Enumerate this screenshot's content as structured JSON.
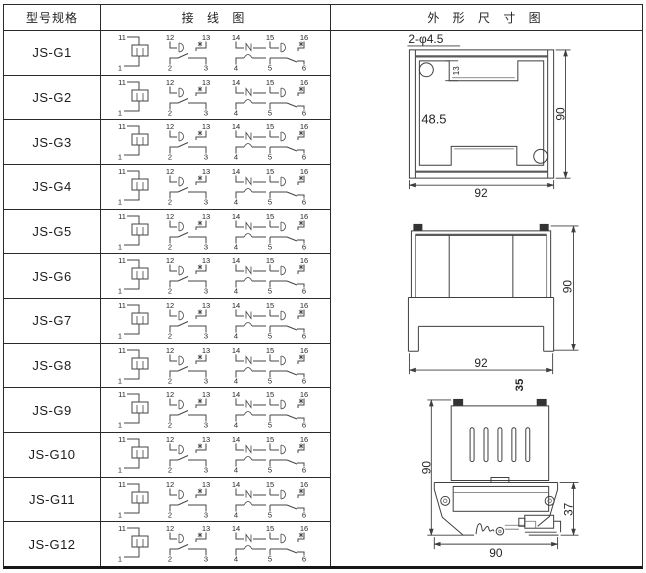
{
  "header": {
    "col_model": "型号规格",
    "col_wiring": "接 线 图",
    "col_outline": "外 形 尺 寸 图"
  },
  "table": {
    "rows": [
      {
        "model": "JS-G1"
      },
      {
        "model": "JS-G2"
      },
      {
        "model": "JS-G3"
      },
      {
        "model": "JS-G4"
      },
      {
        "model": "JS-G5"
      },
      {
        "model": "JS-G6"
      },
      {
        "model": "JS-G7"
      },
      {
        "model": "JS-G8"
      },
      {
        "model": "JS-G9"
      },
      {
        "model": "JS-G10"
      },
      {
        "model": "JS-G11"
      },
      {
        "model": "JS-G12"
      }
    ],
    "wiring": {
      "top_terminals": [
        "11",
        "12",
        "13",
        "14",
        "15",
        "16"
      ],
      "bottom_terminals": [
        "1",
        "2",
        "3",
        "4",
        "5",
        "6"
      ]
    }
  },
  "outline": {
    "rear_view": {
      "holes_label": "2-φ4.5",
      "notch_dim": "13",
      "inner_dim": "48.5",
      "height_dim": "90",
      "width_dim": "92"
    },
    "front_view": {
      "height_dim": "90",
      "width_dim": "92",
      "rail_label": "35"
    },
    "side_view": {
      "height_dim": "90",
      "clip_dim": "37",
      "width_dim": "90"
    }
  },
  "colors": {
    "line": "#3f3f3f",
    "text": "#1f1f1f",
    "border": "#262626"
  }
}
